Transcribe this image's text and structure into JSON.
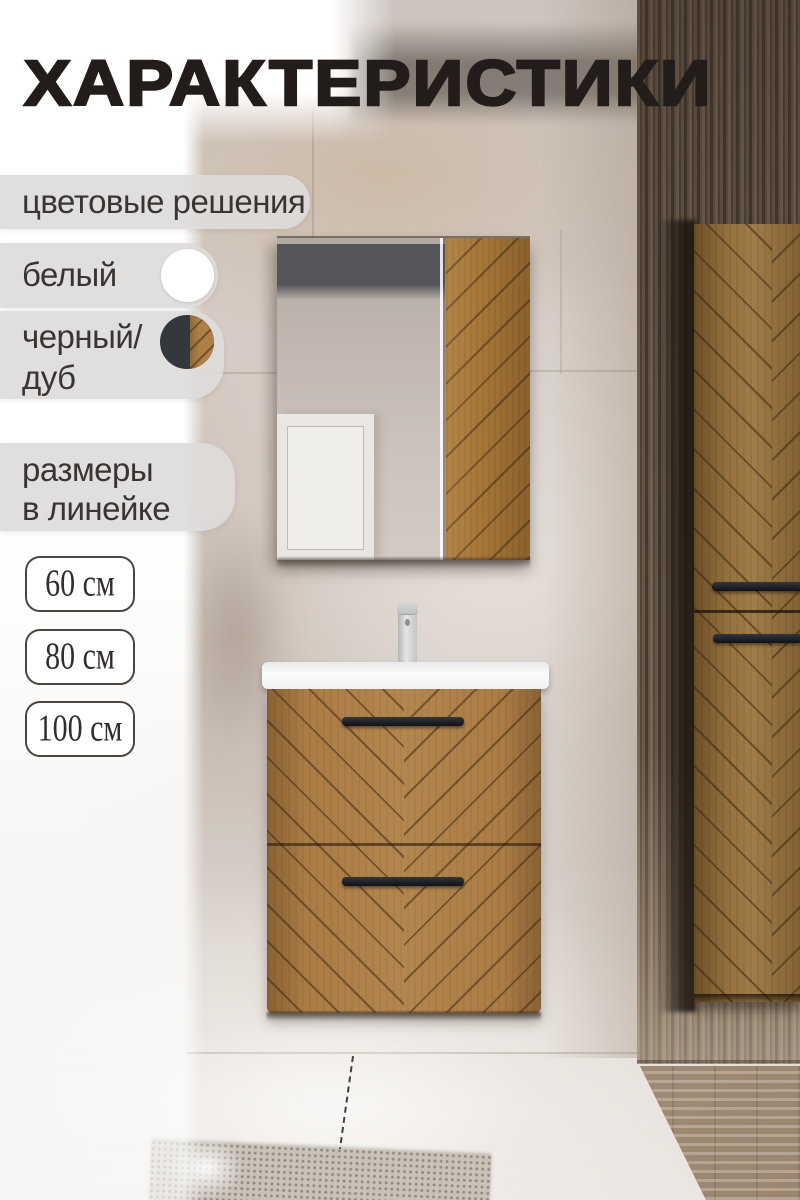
{
  "title": "ХАРАКТЕРИСТИКИ",
  "colors": {
    "section_label": "цветовые решения",
    "white_label": "белый",
    "black_oak_line1": "черный/",
    "black_oak_line2": "дуб",
    "swatch_white": "#ffffff",
    "swatch_black": "#34383c",
    "swatch_oak": "#ae8048"
  },
  "sizes": {
    "section_line1": "размеры",
    "section_line2": "в линейке",
    "options": [
      "60 см",
      "80 см",
      "100 см"
    ]
  },
  "palette": {
    "wood_accent": "#ab7c44",
    "handle_black": "#1f2226",
    "pill_background": "#dedbda",
    "title_color": "#221c1a"
  }
}
